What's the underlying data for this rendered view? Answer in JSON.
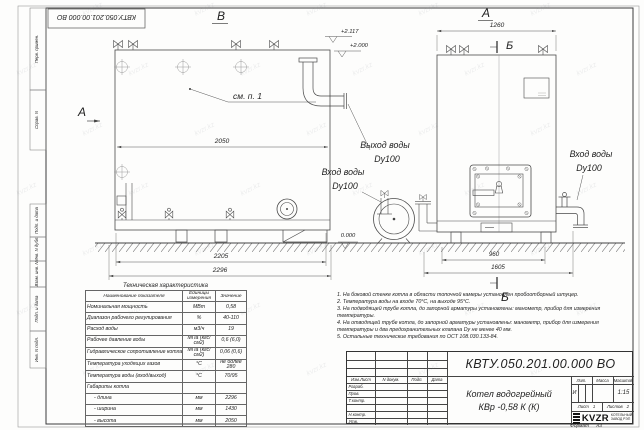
{
  "stamp_top": "КВТУ.050.201.00.000  ВО",
  "watermark": "kvzr.kz",
  "margin_labels": [
    "Перв. примен.",
    "Справ. N",
    "Подп. и дата",
    "Инв. N дубл.",
    "Взам. инв. N",
    "Подп. и дата",
    "Инв. N подл."
  ],
  "views": {
    "view_b_label": "В",
    "view_a_label": "А",
    "view_a_arrow_label": "А",
    "section_b_top": "Б",
    "section_b_bottom": "Б",
    "see_note": "см. п. 1",
    "elev_2117": "+2.117",
    "elev_2000": "+2.000",
    "elev_0": "0.000",
    "dims": {
      "d2050": "2050",
      "d2205": "2205",
      "d2296": "2296",
      "d1260": "1260",
      "d960": "960",
      "d1605": "1605"
    },
    "labels": {
      "outlet_line1": "Выход воды",
      "outlet_line2": "Dy100",
      "inlet_line1": "Вход воды",
      "inlet_line2": "Dy100",
      "inlet2_line1": "Вход воды",
      "inlet2_line2": "Dy100"
    }
  },
  "tech_table": {
    "title": "Техническая характеристика",
    "col_name": "Наименование показателя",
    "col_units": "Единицы измерения",
    "col_value": "Значение",
    "rows": [
      {
        "name": "Номинальная мощность",
        "units": "МВт",
        "value": "0,58"
      },
      {
        "name": "Диапазон рабочего регулирования",
        "units": "%",
        "value": "40-110"
      },
      {
        "name": "Расход воды",
        "units": "м3/ч",
        "value": "19"
      },
      {
        "name": "Рабочее давление воды",
        "units": "МПа (кгс/см2)",
        "value": "0,6 (6,0)"
      },
      {
        "name": "Гидравлическое сопротивление котла",
        "units": "МПа (кгс/см2)",
        "value": "0,06 (0,6)"
      },
      {
        "name": "Температура уходящих газов",
        "units": "°С",
        "value": "не более 280"
      },
      {
        "name": "Температура воды (вход/выход)",
        "units": "°С",
        "value": "70/95"
      },
      {
        "name": "Габариты котла",
        "units": "",
        "value": ""
      },
      {
        "name": "- длина",
        "units": "мм",
        "value": "2296"
      },
      {
        "name": "- ширина",
        "units": "мм",
        "value": "1430"
      },
      {
        "name": "- высота",
        "units": "мм",
        "value": "2050"
      }
    ]
  },
  "notes": [
    "1. На боковой стенке котла в области топочной камеры установлен пробоотборный штуцер.",
    "2. Температура воды на входе 70°С, на выходе 95°С.",
    "3. На подводящей трубе котла, до запорной арматуры установлены: манометр, прибор для измерения температуры.",
    "4. На отводящей трубе котла, до запорной арматуры установлены: манометр, прибор для измерения температуры и два предохранительных клапана Dy не менее 40 мм.",
    "5. Остальные технические требования по ОСТ 108.030.133-84."
  ],
  "title_block": {
    "designation": "КВТУ.050.201.00.000  ВО",
    "product_line1": "Котел водогрейный",
    "product_line2": "КВр -0,58  К  (К)",
    "col_izm": "Изм.Лист",
    "col_doc": "N докум.",
    "col_sign": "Подп.",
    "col_date": "Дата",
    "row_razrab": "Разраб.",
    "row_prov": "Пров.",
    "row_tkontr": "Т.контр.",
    "row_nkontr": "Н.контр.",
    "row_utv": "Утв.",
    "lit_label": "Лит.",
    "mass_label": "Масса",
    "scale_label": "Масштаб",
    "lit_value": "И",
    "scale_value": "1:15",
    "sheet_label": "Лист",
    "sheet_value": "1",
    "sheets_label": "Листов",
    "sheets_value": "2",
    "logo_text": "KVZR",
    "logo_sub1": "КОТЕЛЬНЫЙ",
    "logo_sub2": "ЗАВОД РЭП",
    "format_label": "Формат",
    "format_value": "А3"
  }
}
